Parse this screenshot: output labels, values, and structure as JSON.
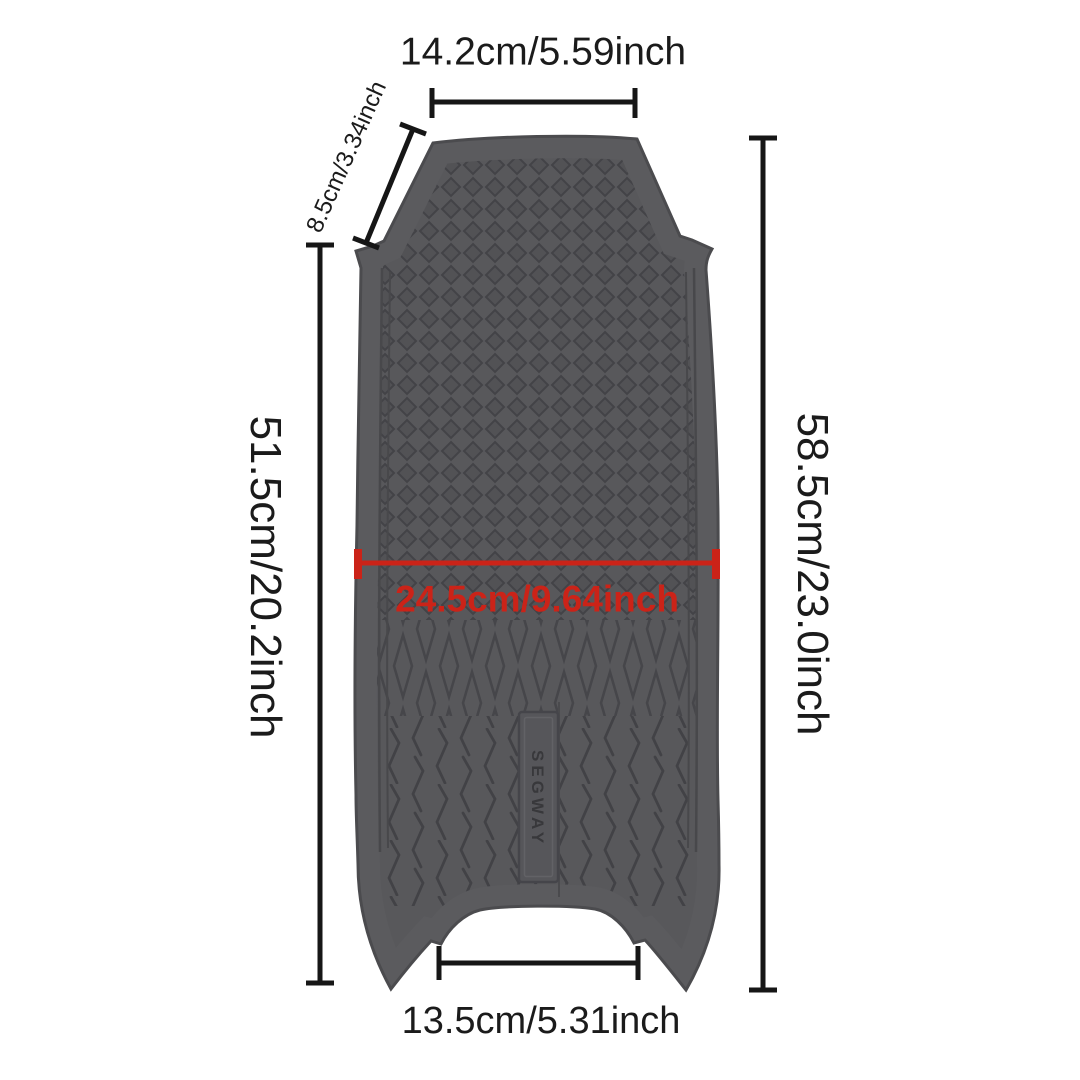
{
  "page": {
    "background": "#ffffff"
  },
  "product": {
    "name": "scooter-foot-mat",
    "brand_label": "SEGWAY",
    "colors": {
      "mat_base": "#58585b",
      "texture_line": "#454548",
      "edge_outline": "#4b4b4e"
    }
  },
  "annotations": {
    "top_width": {
      "label": "14.2cm/5.59inch",
      "cm": 14.2,
      "inch": 5.59
    },
    "shoulder_depth": {
      "label": "8.5cm/3.34inch",
      "cm": 8.5,
      "inch": 3.34
    },
    "left_height": {
      "label": "51.5cm/20.2inch",
      "cm": 51.5,
      "inch": 20.2
    },
    "right_height": {
      "label": "58.5cm/23.0inch",
      "cm": 58.5,
      "inch": 23.0
    },
    "middle_width": {
      "label": "24.5cm/9.64inch",
      "cm": 24.5,
      "inch": 9.64,
      "color": "#cb2318"
    },
    "bottom_width": {
      "label": "13.5cm/5.31inch",
      "cm": 13.5,
      "inch": 5.31
    }
  },
  "dimension_line_color": "#161616"
}
